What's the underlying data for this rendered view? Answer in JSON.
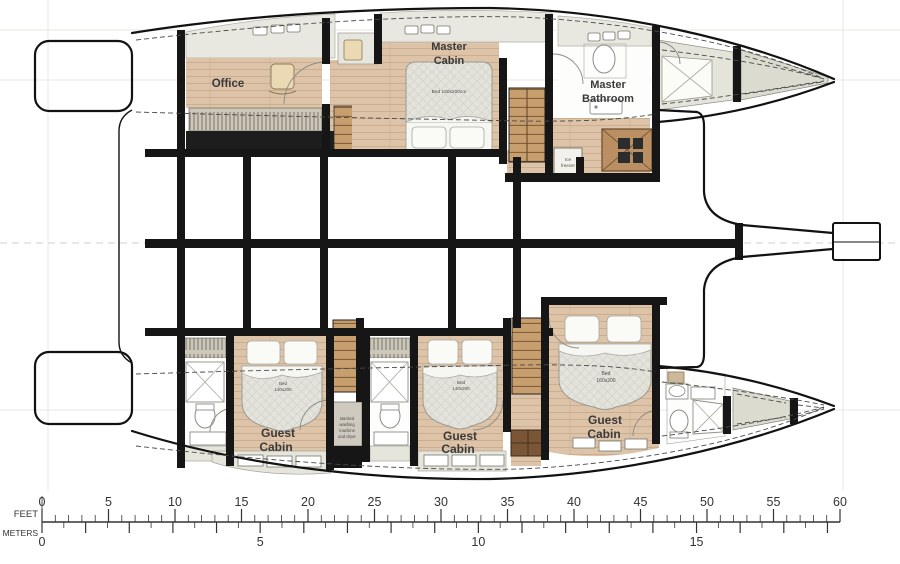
{
  "title": "Catamaran lower deck floor plan",
  "rooms": {
    "office": {
      "label": "Office"
    },
    "master_cabin": {
      "label_lines": [
        "Master",
        "Cabin"
      ],
      "bed_label": "Bed 160x200cm"
    },
    "master_bathroom": {
      "label_lines": [
        "Master",
        "Bathroom"
      ]
    },
    "galley": {
      "ice_freezer_lines": [
        "Ice",
        "freezer"
      ]
    },
    "laundry": {
      "label_lines": [
        "stacked",
        "washing",
        "machine",
        "and dryer"
      ]
    },
    "guest_cabin_1": {
      "label_lines": [
        "Guest",
        "Cabin"
      ],
      "bed_label_lines": [
        "Bed",
        "140x200"
      ]
    },
    "guest_cabin_2": {
      "label_lines": [
        "Guest",
        "Cabin"
      ],
      "bed_label_lines": [
        "Bed",
        "140x200"
      ]
    },
    "guest_cabin_3": {
      "label_lines": [
        "Guest",
        "Cabin"
      ],
      "bed_label_lines": [
        "Bed",
        "160x200"
      ]
    }
  },
  "scale_bar": {
    "feet_title": "FEET",
    "meters_title": "METERS",
    "feet_tick_labels": [
      "0",
      "5",
      "10",
      "15",
      "20",
      "25",
      "30",
      "35",
      "40",
      "45",
      "50",
      "55",
      "60"
    ],
    "meters_tick_labels": [
      "0",
      "5",
      "10",
      "15"
    ]
  },
  "colors": {
    "wood_floor": "#ddc3a8",
    "walls": "#161616",
    "deck_gray": "#dbdbd0",
    "furniture_gray": "#e6e5dc",
    "mattress": "#e3e2db"
  }
}
